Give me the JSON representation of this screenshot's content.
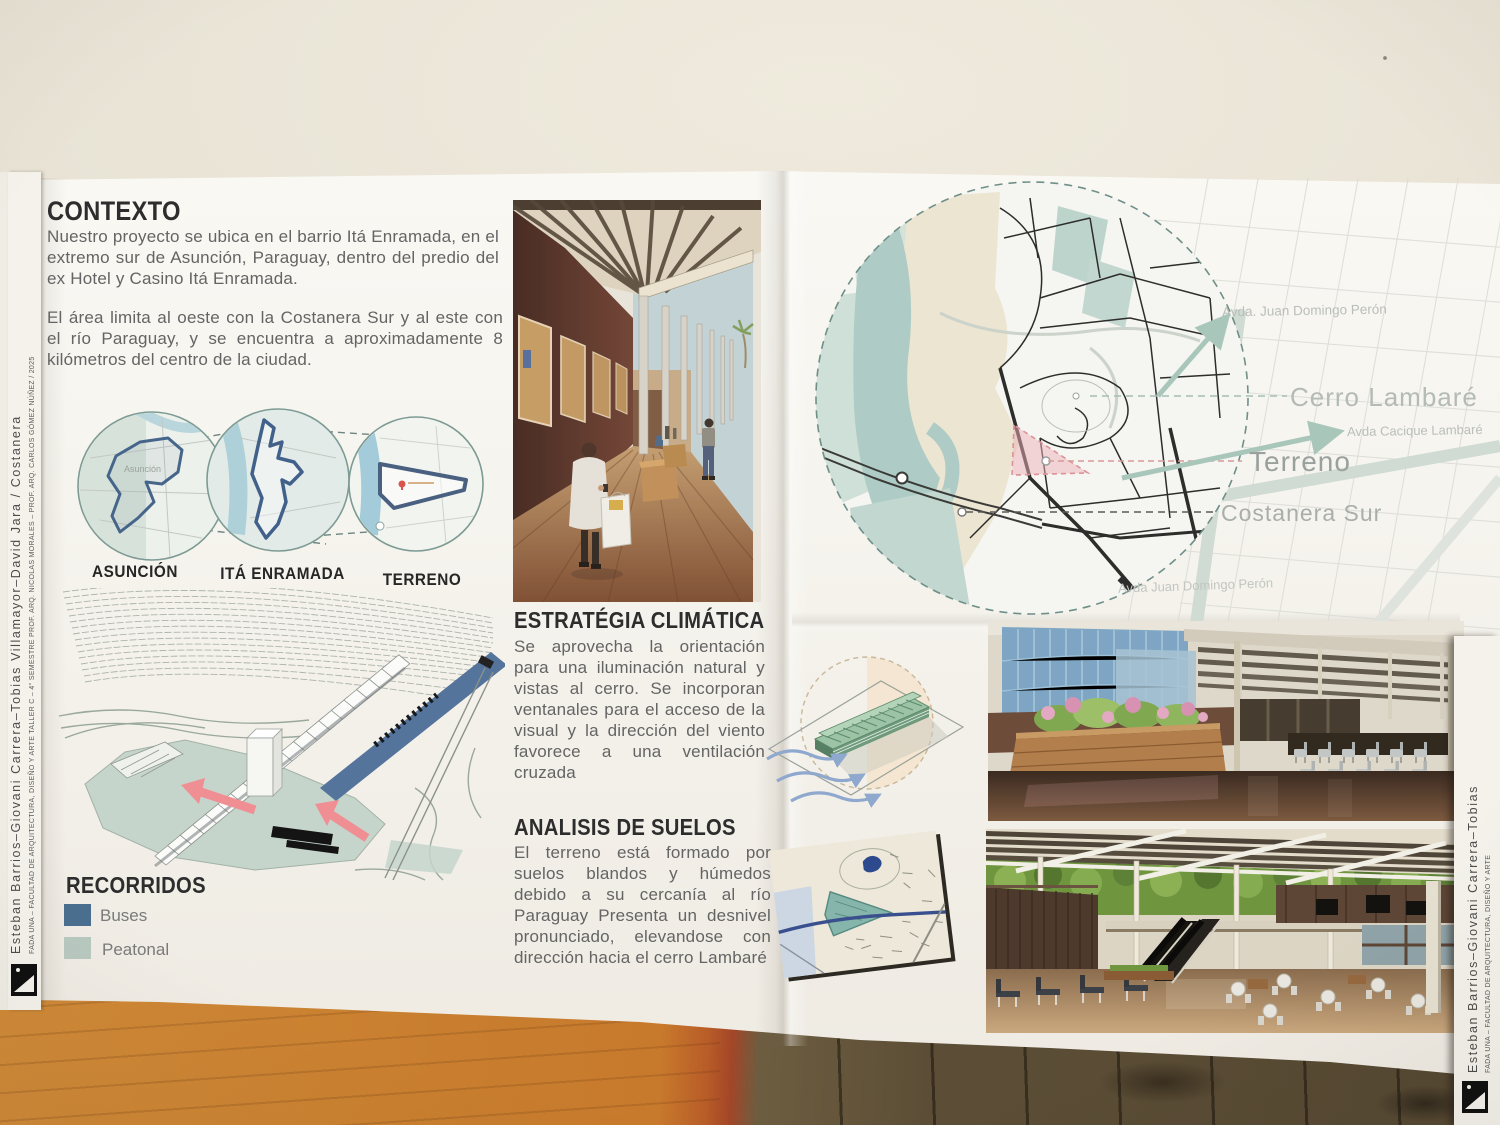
{
  "contexto": {
    "title": "CONTEXTO",
    "paragraph1": "Nuestro proyecto se ubica en el barrio Itá Enramada, en el extremo sur de Asunción, Paraguay, dentro del predio  del ex Hotel y Casino Itá Enramada.",
    "paragraph2": "El área limita al oeste  con la Costanera Sur y al este con el río Paraguay,  y  se    encuentra  a aproximadamente 8 kilómetros del centro  de la ciudad."
  },
  "locations": {
    "items": [
      {
        "label": "ASUNCIÓN"
      },
      {
        "label": "ITÁ ENRAMADA"
      },
      {
        "label": "TERRENO"
      }
    ],
    "asuncion_map_label": "Asunción"
  },
  "recorridos": {
    "title": "RECORRIDOS",
    "legend": [
      {
        "label": "Buses",
        "color": "#4a6f8e"
      },
      {
        "label": "Peatonal",
        "color": "#b8c9c0"
      }
    ]
  },
  "estrategia": {
    "title": "ESTRATÉGIA CLIMÁTICA",
    "body": "Se aprovecha la orientación para una iluminación natural y vistas al cerro. Se incorporan ventanales para el acceso de la visual y la dirección del viento favorece a una ventilación cruzada"
  },
  "suelos": {
    "title": "ANALISIS DE SUELOS",
    "body": "El terreno está formado por suelos blandos y húmedos debido a su cercanía al río Paraguay Presenta un desnivel pronunciado, elevandose con dirección hacia el cerro Lambaré"
  },
  "map": {
    "labels": {
      "avda_peron_top": "Avda. Juan Domingo Perón",
      "cerro_lambare": "Cerro Lambaré",
      "avda_cacique": "Avda Cacique Lambaré",
      "terreno": "Terreno",
      "costanera_sur": "Costanera Sur",
      "avda_peron_bottom": "Avda Juan Domingo Perón"
    }
  },
  "spines": {
    "left": {
      "names": "Esteban Barrios–Giovani Carrera–Tobias Villamayor–David Jara / Costanera",
      "course": "FADA UNA – FACULTAD DE ARQUITECTURA, DISEÑO Y ARTE    TALLER C – 4° SEMESTRE    PROF. ARQ. NICOLAS MORALES – PROF. ARQ. CARLOS GÓMEZ NÚÑEZ / 2025"
    },
    "right": {
      "names": "Esteban Barrios–Giovani Carrera–Tobias",
      "course": "FADA UNA – FACULTAD DE ARQUITECTURA, DISEÑO Y ARTE"
    }
  },
  "colors": {
    "buses": "#4a6f8e",
    "peatonal": "#b8c9c0",
    "water": "#54749c",
    "arrow_pink": "#ef8f94",
    "terreno_pink": "#eeb2b8",
    "teal_avenue": "#a9c6bb"
  }
}
